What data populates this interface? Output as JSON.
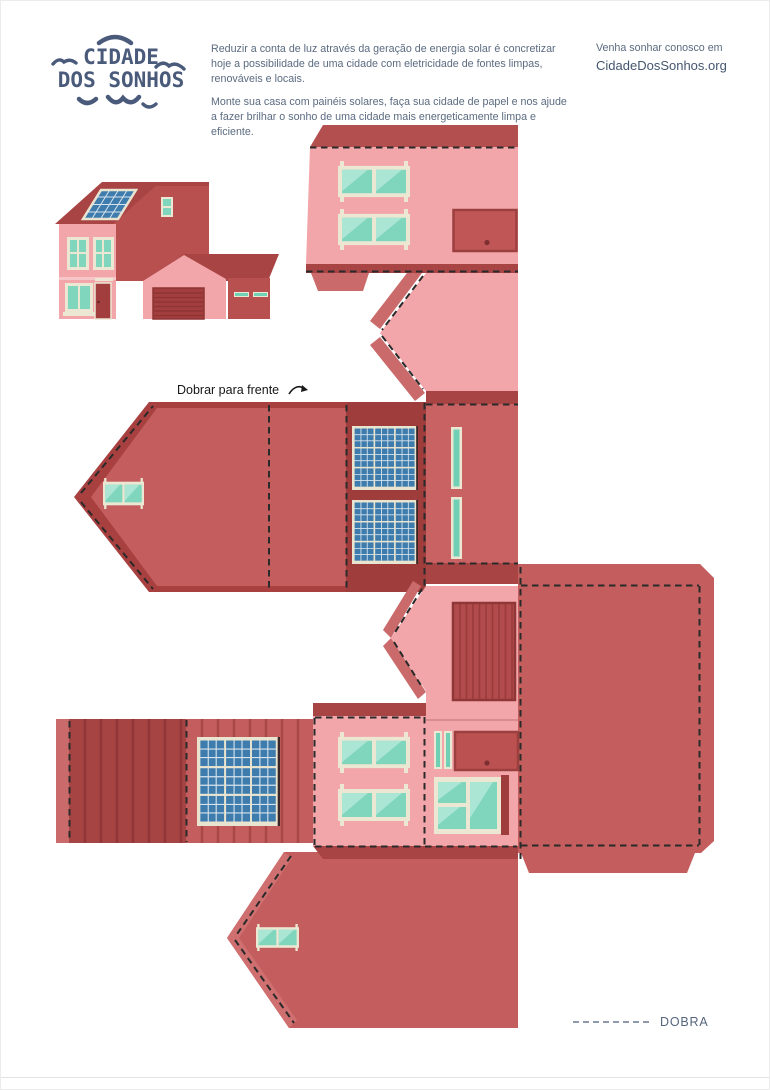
{
  "header": {
    "logo": {
      "line1": "CIDADE",
      "line2": "DOS SONHOS"
    },
    "intro": {
      "paragraph1": "Reduzir a conta de luz através da geração de energia solar é concretizar hoje a possibilidade de uma cidade com eletricidade de fontes limpas, renováveis e locais.",
      "paragraph2": "Monte sua casa com painéis solares, faça sua cidade de papel e nos ajude a fazer brilhar o sonho de uma cidade mais energeticamente limpa e eficiente."
    },
    "contact": {
      "invite": "Venha sonhar conosco em",
      "website": "CidadeDosSonhos.org"
    }
  },
  "labels": {
    "fold_forward": "Dobrar para frente",
    "fold_legend": "DOBRA"
  },
  "colors": {
    "wall_pink": "#f3a6aa",
    "roof_red": "#c45e5e",
    "dark_red": "#a84444",
    "deep_red": "#9f3c3c",
    "tab_red": "#cb6a6a",
    "door_red": "#bb5151",
    "glass_teal": "#7fd6bd",
    "glass_highlight": "#abe5d3",
    "frame_cream": "#ece7d3",
    "solar_blue": "#3e7cad",
    "logo_blue": "#4a5a7a",
    "body_text": "#5b6b80",
    "fold_line": "#2a2a2a"
  }
}
